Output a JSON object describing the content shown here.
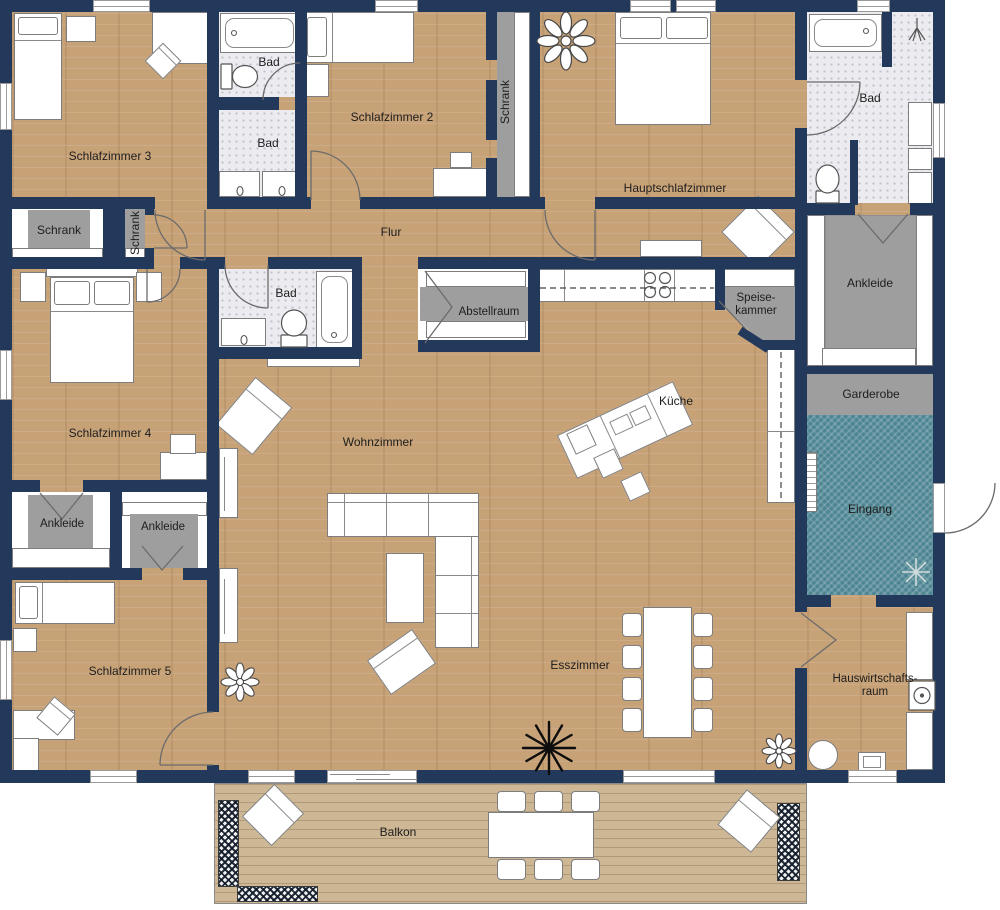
{
  "labels": {
    "schlafzimmer3": "Schlafzimmer 3",
    "schlafzimmer2": "Schlafzimmer 2",
    "schlafzimmer4": "Schlafzimmer 4",
    "schlafzimmer5": "Schlafzimmer 5",
    "hauptschlafzimmer": "Hauptschlafzimmer",
    "bad": "Bad",
    "schrank": "Schrank",
    "flur": "Flur",
    "wohnzimmer": "Wohnzimmer",
    "kueche": "Küche",
    "esszimmer": "Esszimmer",
    "abstellraum": "Abstellraum",
    "speisekammer_line1": "Speise-",
    "speisekammer_line2": "kammer",
    "ankleide": "Ankleide",
    "garderobe": "Garderobe",
    "eingang": "Eingang",
    "hwr_line1": "Hauswirtschafts-",
    "hwr_line2": "raum",
    "balkon": "Balkon"
  },
  "colors": {
    "wall": "#23395c",
    "wood_floor": "#c8a277",
    "tile": "#ebebf0",
    "closet_gray": "#9e9e9e",
    "entry_teal": "#4d8492",
    "deck": "#cdb795",
    "label_text": "#1d1d1d"
  }
}
